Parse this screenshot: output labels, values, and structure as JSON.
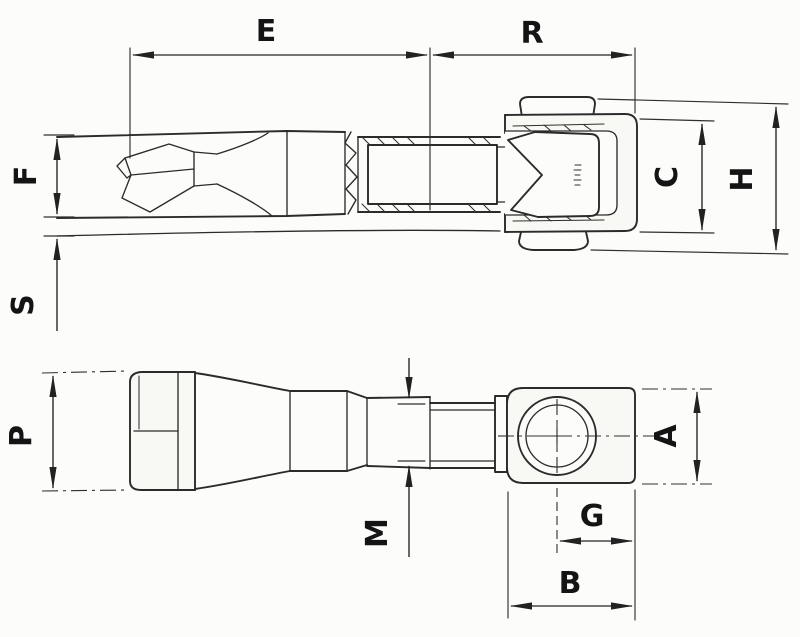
{
  "diagram": {
    "background_color": "#fcfcfb",
    "line_color": "#2b2b2b",
    "label_color": "#141414",
    "dimensions": {
      "E": "E",
      "R": "R",
      "F": "F",
      "S": "S",
      "C": "C",
      "H": "H",
      "P": "P",
      "M": "M",
      "A": "A",
      "G": "G",
      "B": "B"
    }
  }
}
